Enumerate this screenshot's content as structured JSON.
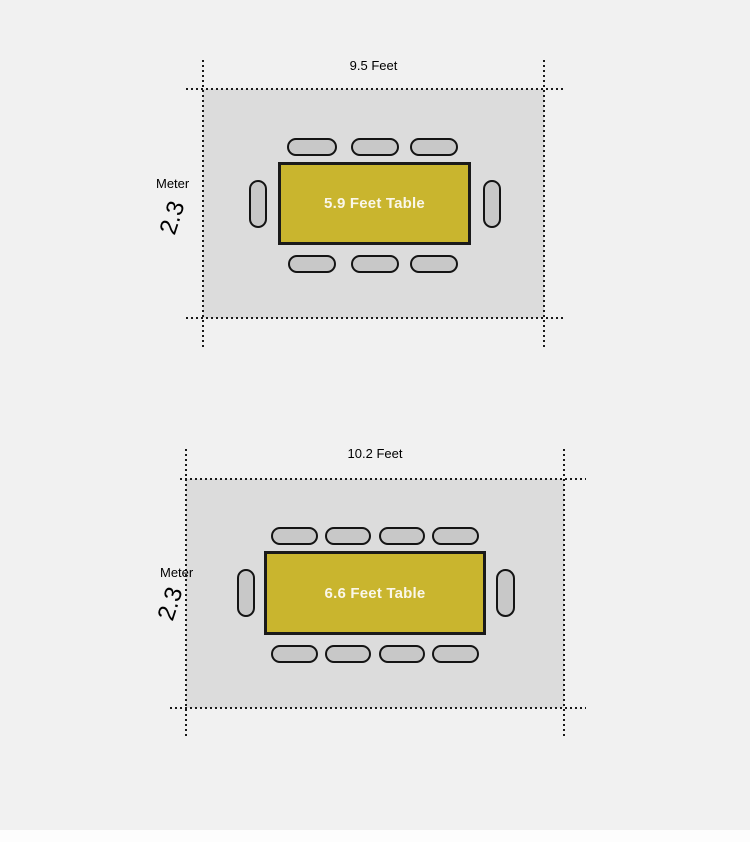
{
  "colors": {
    "page_bg": "#f1f1f1",
    "room_fill": "#dcdcdc",
    "chair_fill": "#c8c8c8",
    "chair_border": "#141414",
    "table_fill": "#c9b52e",
    "table_border": "#1a1a1a",
    "table_text": "#faf7ea",
    "dotted_line": "#1a1a1a",
    "label_text": "#000000",
    "footer_strip": "#fdfdfd"
  },
  "diagrams": [
    {
      "width_label": "9.5 Feet",
      "height_value": "2.3",
      "height_unit": "Meter",
      "table_label": "5.9 Feet Table",
      "chairs": {
        "top": 3,
        "bottom": 3,
        "left": 1,
        "right": 1,
        "total": 8
      }
    },
    {
      "width_label": "10.2 Feet",
      "height_value": "2.3",
      "height_unit": "Meter",
      "table_label": "6.6 Feet Table",
      "chairs": {
        "top": 4,
        "bottom": 4,
        "left": 1,
        "right": 1,
        "total": 10
      }
    }
  ]
}
